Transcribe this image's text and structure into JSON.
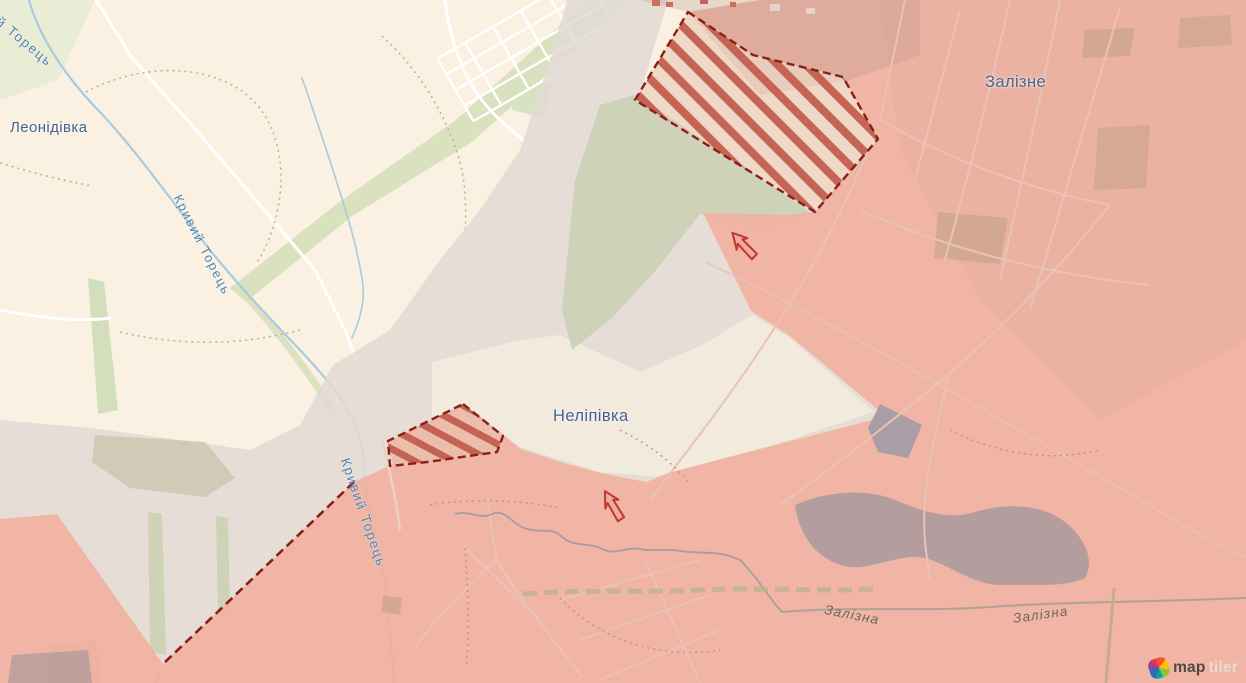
{
  "map_labels": {
    "towns": [
      {
        "id": "leonidivka",
        "name": "Леонідівка"
      },
      {
        "id": "zalizne",
        "name": "Залізне"
      },
      {
        "id": "nelipivka",
        "name": "Неліпівка"
      }
    ],
    "rivers": [
      {
        "id": "kryvyi-torets-upper-cut",
        "name": "ий Торець"
      },
      {
        "id": "kryvyi-torets-mid",
        "name": "Кривий Торець"
      },
      {
        "id": "kryvyi-torets-lower",
        "name": "Кривий Торець"
      },
      {
        "id": "zalizna-west",
        "name": "Залізна"
      },
      {
        "id": "zalizna-east",
        "name": "Залізна"
      }
    ]
  },
  "attribution": {
    "brand_map": "map",
    "brand_tiler": "tiler"
  },
  "colors": {
    "occupied_area": "#efb1a1",
    "grey_zone": "#e2dbd3",
    "assault_area_stripe": "#c05a4a",
    "frontline_dashed": "#8a1f18",
    "advance_arrow": "#c23b30",
    "water_label": "#4c88b6",
    "town_label": "#44638a"
  },
  "markers": {
    "advance_arrows": 2,
    "assault_hatched_areas": 2
  }
}
